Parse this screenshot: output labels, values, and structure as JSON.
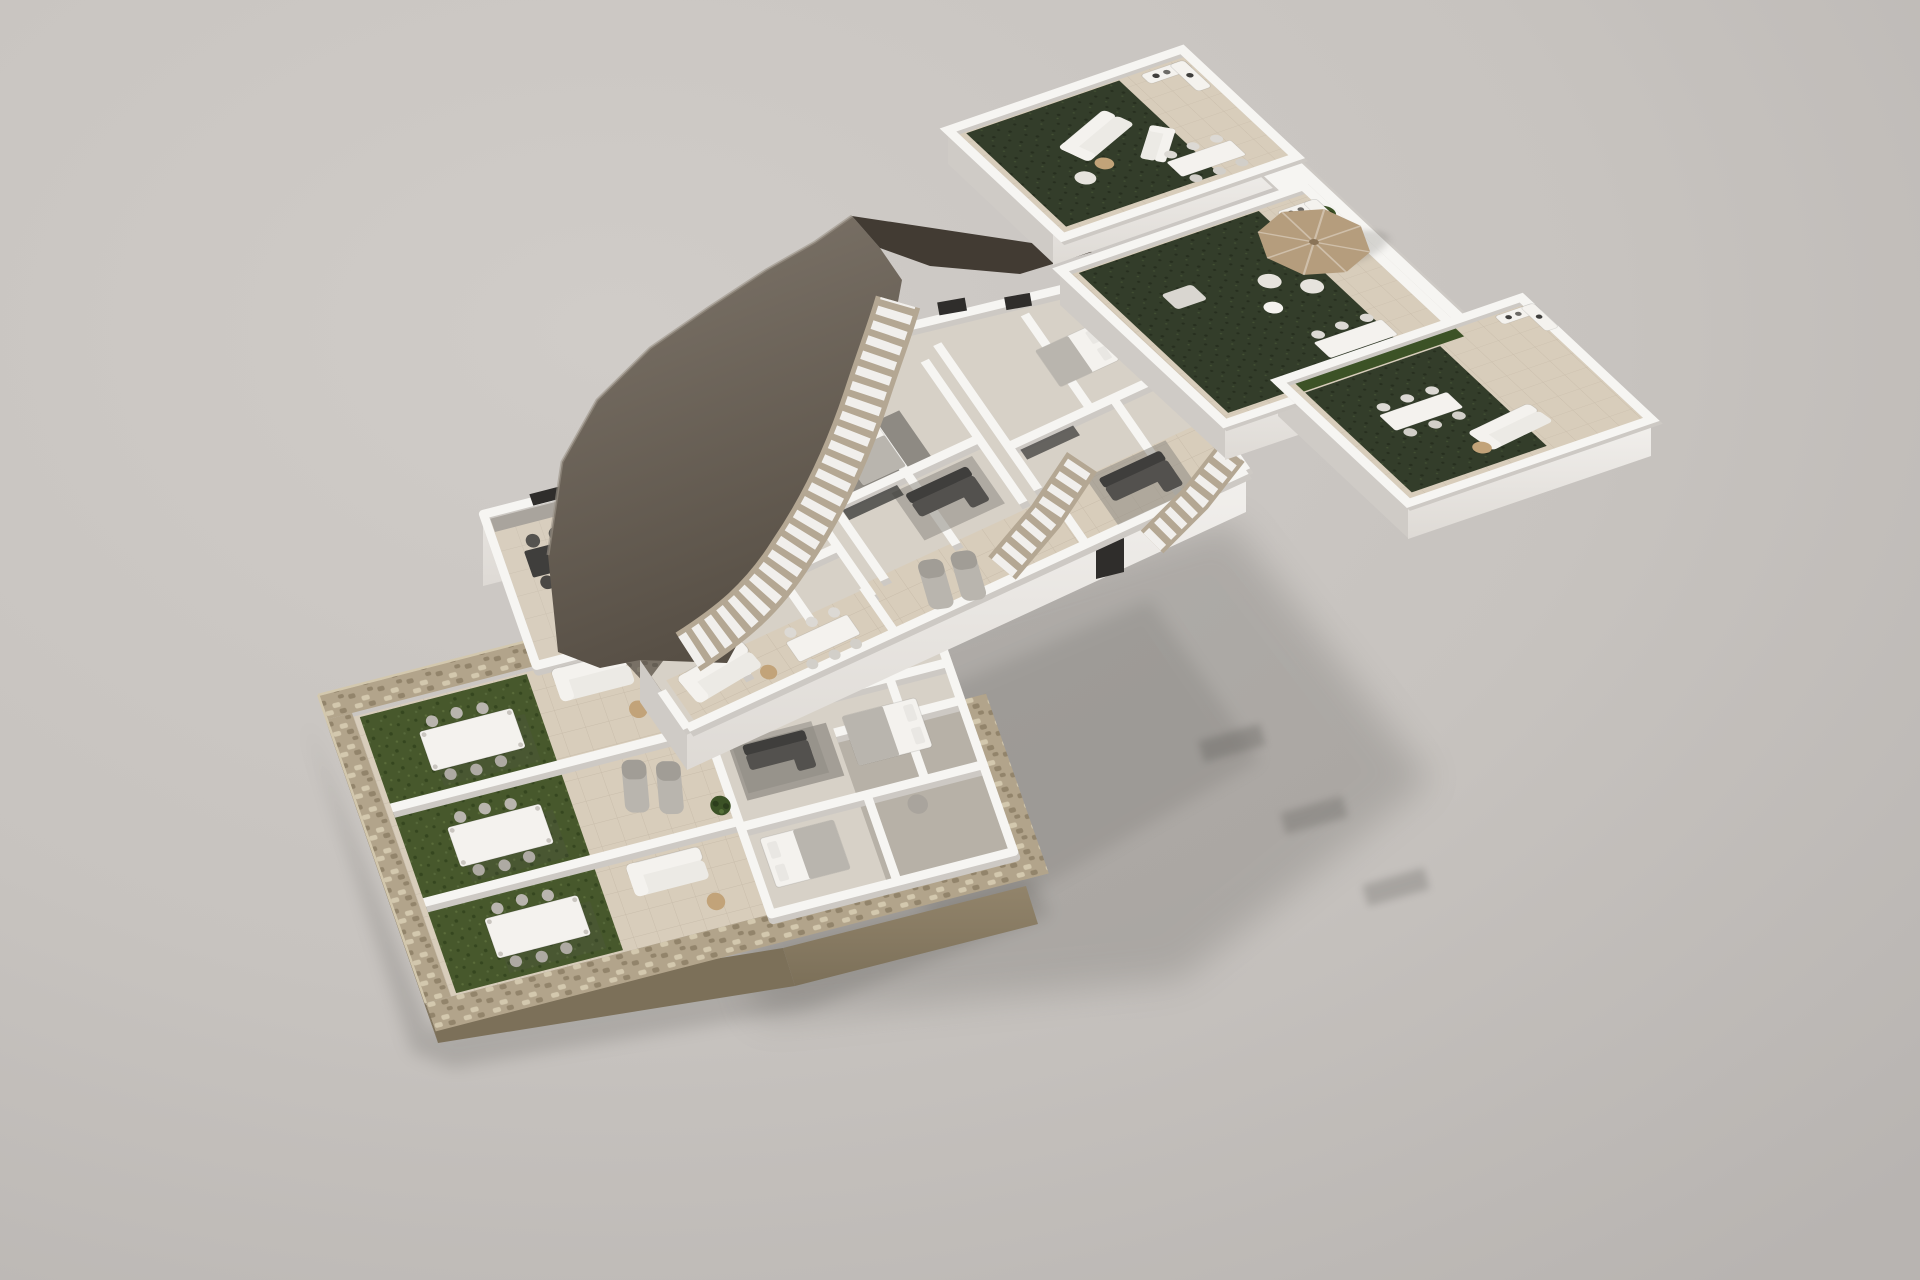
{
  "scene": {
    "type": "architectural-3d-floor-plan-render",
    "projection": "axonometric-exploded",
    "background": "plain-studio-gray",
    "levels": [
      {
        "id": "ground-floor",
        "position": "bottom-left",
        "elements": [
          "stone perimeter wall",
          "three lawn gardens",
          "pergola dining tables",
          "garden lounge sets",
          "interior rooms with sofas and beds",
          "stone plinth base"
        ]
      },
      {
        "id": "first-floor",
        "position": "center",
        "elements": [
          "jagged rock hillside edge",
          "three outdoor staircases",
          "tiled terraces with dining and lounge sets",
          "bedrooms and living rooms",
          "large cast shadow on ground"
        ]
      },
      {
        "id": "roof-solarium",
        "position": "top-right",
        "elements": [
          "three solarium terraces",
          "artificial turf decks",
          "parasol",
          "outdoor dining tables",
          "corner sofas",
          "hedge strip"
        ]
      }
    ]
  },
  "colors": {
    "bg1": "#d0ccc8",
    "bg2": "#c7c3bf",
    "bg3": "#b8b4b1",
    "wall": "#f6f5f2",
    "wallShade": "#e6e3de",
    "wallDark": "#cdc9c4",
    "tile": "#d8cdbb",
    "floorIn": "#d7d1c7",
    "floorGray": "#b7b1a7",
    "carpet": "#8e8a83",
    "lawn": "#47582c",
    "lawnDot": "#35461f",
    "turf": "#333d2a",
    "turfDot": "#272f1f",
    "stone": "#b2a48b",
    "stoneDark": "#92846b",
    "stoneDeep": "#7c7059",
    "stoneLight": "#d3c8ae",
    "cliff": "#80776c",
    "cliffDark": "#574f45",
    "wedge": "#423b33",
    "stair": "#f1efec",
    "stringer": "#b4a793",
    "charcoal": "#3f3e3c",
    "grayFurn": "#a9a49d",
    "wood": "#c2a379",
    "woodDark": "#9b8158",
    "furnWhite": "#f4f2ee",
    "plant": "#3c5226",
    "window": "#2f2d2b",
    "shadow": "#55524f",
    "faceBright": "#f2f0ed",
    "faceMid": "#dedad5",
    "faceDim": "#cfcbc6"
  }
}
